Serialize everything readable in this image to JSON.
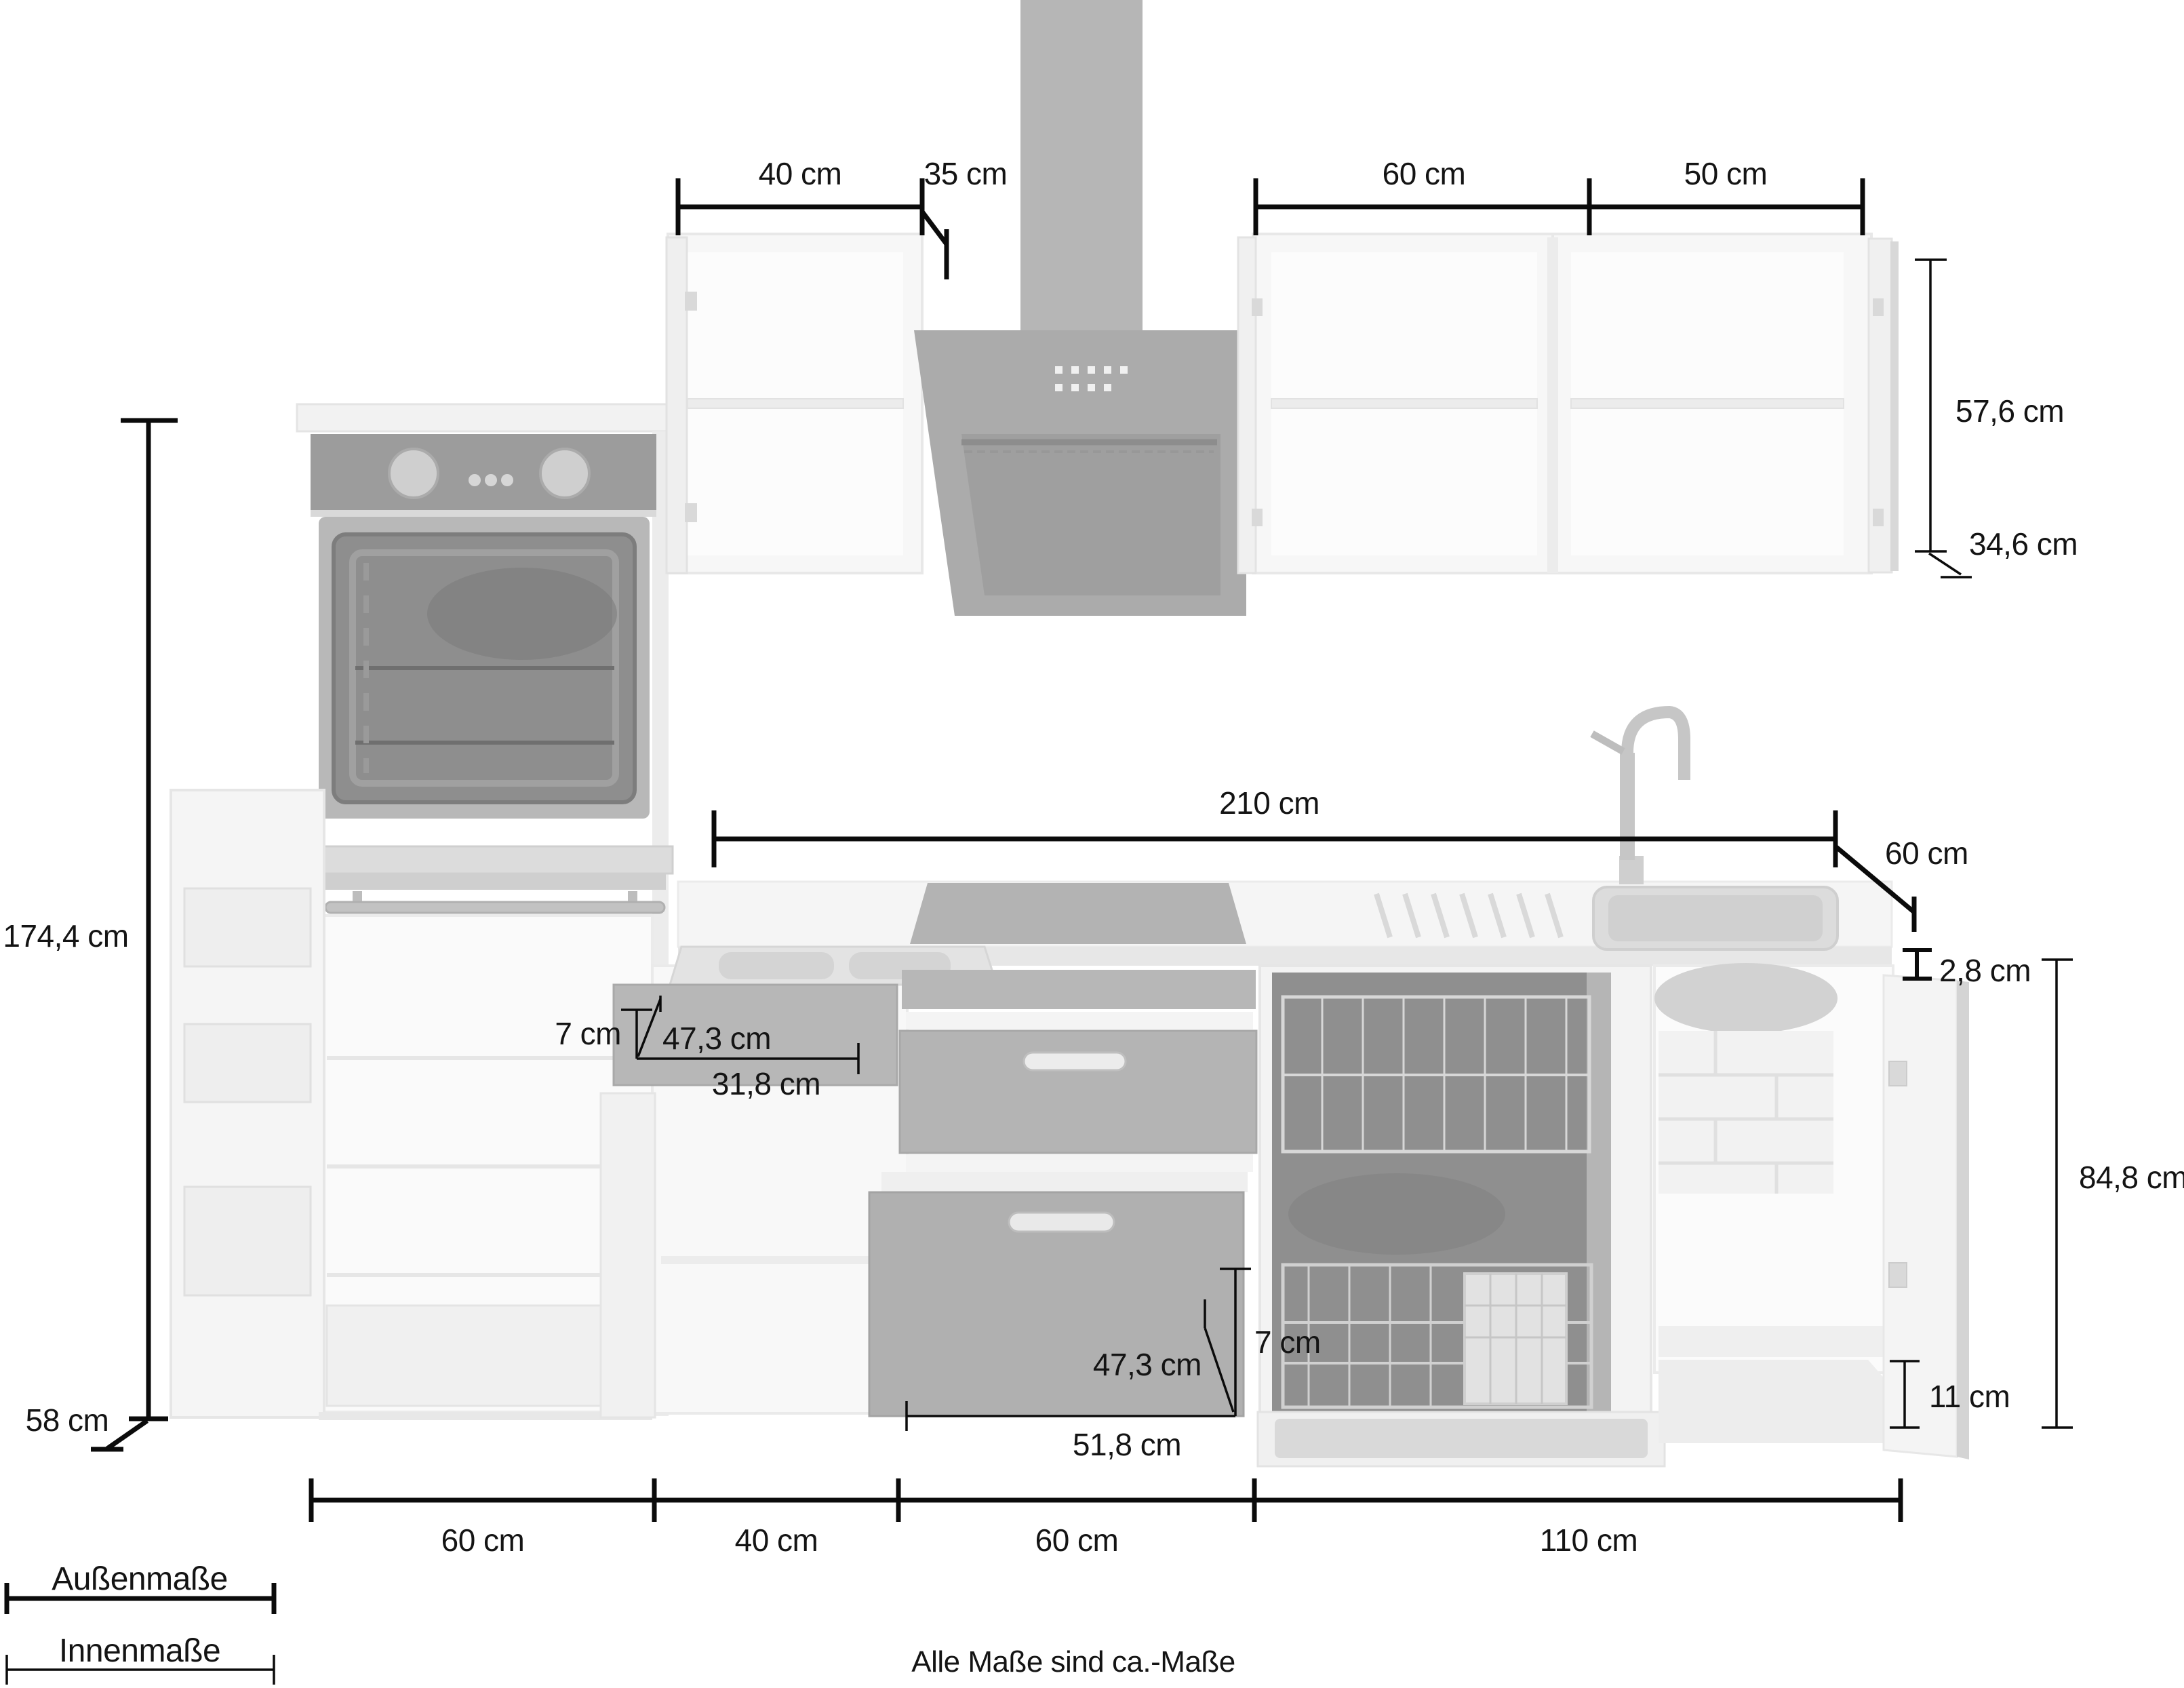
{
  "title": "Küchenzeile Maßzeichnung",
  "footer": {
    "note": "Alle Maße sind ca.-Maße"
  },
  "legend": {
    "outer": "Außenmaße",
    "inner": "Innenmaße"
  },
  "dims": {
    "wall_left_width": {
      "label": "40 cm",
      "type": "outer"
    },
    "hood_depth": {
      "label": "35 cm",
      "type": "outer"
    },
    "wall_right_width_1": {
      "label": "60 cm",
      "type": "outer"
    },
    "wall_right_width_2": {
      "label": "50 cm",
      "type": "outer"
    },
    "wall_inner_height": {
      "label": "57,6 cm",
      "type": "inner"
    },
    "wall_inner_depth": {
      "label": "34,6 cm",
      "type": "inner"
    },
    "total_height": {
      "label": "174,4 cm",
      "type": "outer"
    },
    "worktop_run": {
      "label": "210 cm",
      "type": "outer"
    },
    "worktop_depth": {
      "label": "60 cm",
      "type": "outer"
    },
    "worktop_thickness": {
      "label": "2,8 cm",
      "type": "outer"
    },
    "base_inner_height": {
      "label": "84,8 cm",
      "type": "inner"
    },
    "drawer_small_inner_height": {
      "label": "7 cm",
      "type": "inner"
    },
    "drawer_small_inner_depth": {
      "label": "47,3 cm",
      "type": "inner"
    },
    "drawer_small_inner_width": {
      "label": "31,8 cm",
      "type": "inner"
    },
    "drawer_large_inner_height": {
      "label": "7 cm",
      "type": "inner"
    },
    "drawer_large_inner_depth": {
      "label": "47,3 cm",
      "type": "inner"
    },
    "drawer_large_inner_width": {
      "label": "51,8 cm",
      "type": "inner"
    },
    "plinth_height": {
      "label": "11 cm",
      "type": "inner"
    },
    "tall_unit_depth": {
      "label": "58 cm",
      "type": "outer"
    },
    "base_width_1": {
      "label": "60 cm",
      "type": "outer"
    },
    "base_width_2": {
      "label": "40 cm",
      "type": "outer"
    },
    "base_width_3": {
      "label": "60 cm",
      "type": "outer"
    },
    "base_width_4": {
      "label": "110 cm",
      "type": "outer"
    }
  },
  "appliances": [
    "oven",
    "refrigerator",
    "extractor-hood",
    "cooktop",
    "sink",
    "dishwasher"
  ],
  "colors": {
    "background": "#ffffff",
    "dimension_line": "#0b0b0b",
    "text": "#141414",
    "drawing_light": "#f5f5f5",
    "drawing_mid": "#b3b3b3",
    "drawing_dark": "#8f8f8f"
  }
}
